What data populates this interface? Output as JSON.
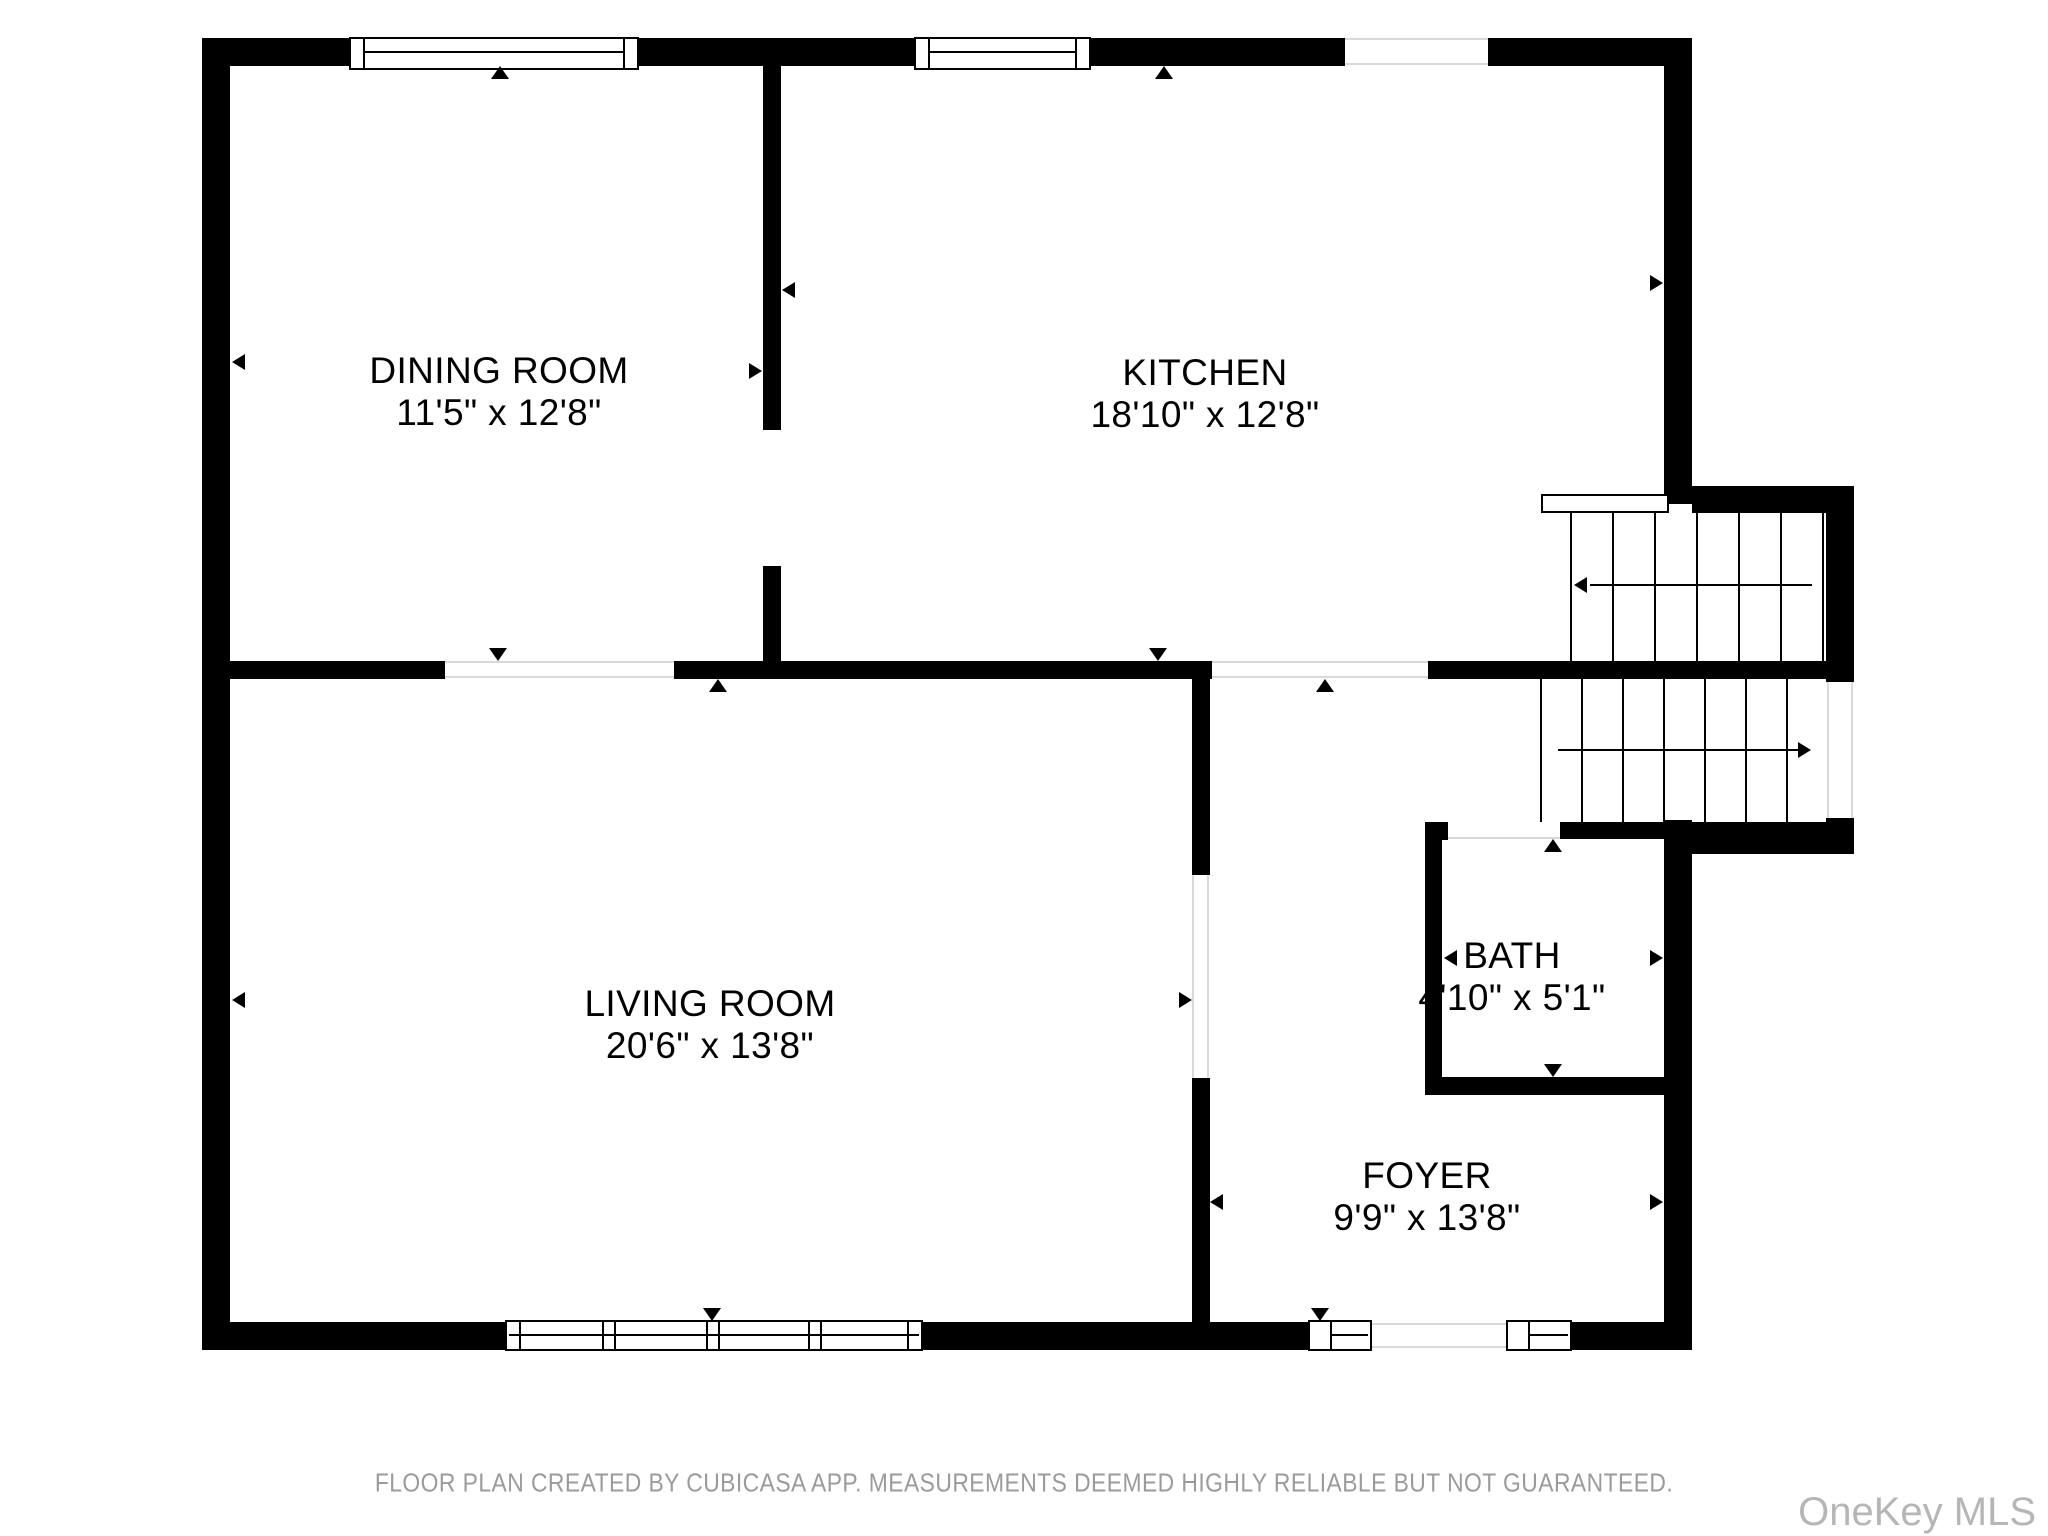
{
  "plan": {
    "rooms": {
      "dining": {
        "name": "DINING ROOM",
        "dims": "11'5\" x 12'8\""
      },
      "kitchen": {
        "name": "KITCHEN",
        "dims": "18'10\" x 12'8\""
      },
      "living": {
        "name": "LIVING ROOM",
        "dims": "20'6\" x 13'8\""
      },
      "bath": {
        "name": "BATH",
        "dims": "4'10\" x 5'1\""
      },
      "foyer": {
        "name": "FOYER",
        "dims": "9'9\" x 13'8\""
      }
    },
    "features": {
      "stairs": "two-flight staircase with up/down direction arrows",
      "windows": "double-line window symbols on exterior walls",
      "entry": "front door opening flanked by two windows"
    },
    "colors": {
      "wall": "#000000",
      "background": "#ffffff",
      "opening_line": "#d9d9d9",
      "footer_text": "#9b9b9b",
      "watermark_text": "#b6b6b6"
    }
  },
  "footer": {
    "disclaimer": "FLOOR PLAN CREATED BY CUBICASA APP. MEASUREMENTS DEEMED HIGHLY RELIABLE BUT NOT GUARANTEED."
  },
  "watermark": {
    "label": "OneKey MLS"
  }
}
